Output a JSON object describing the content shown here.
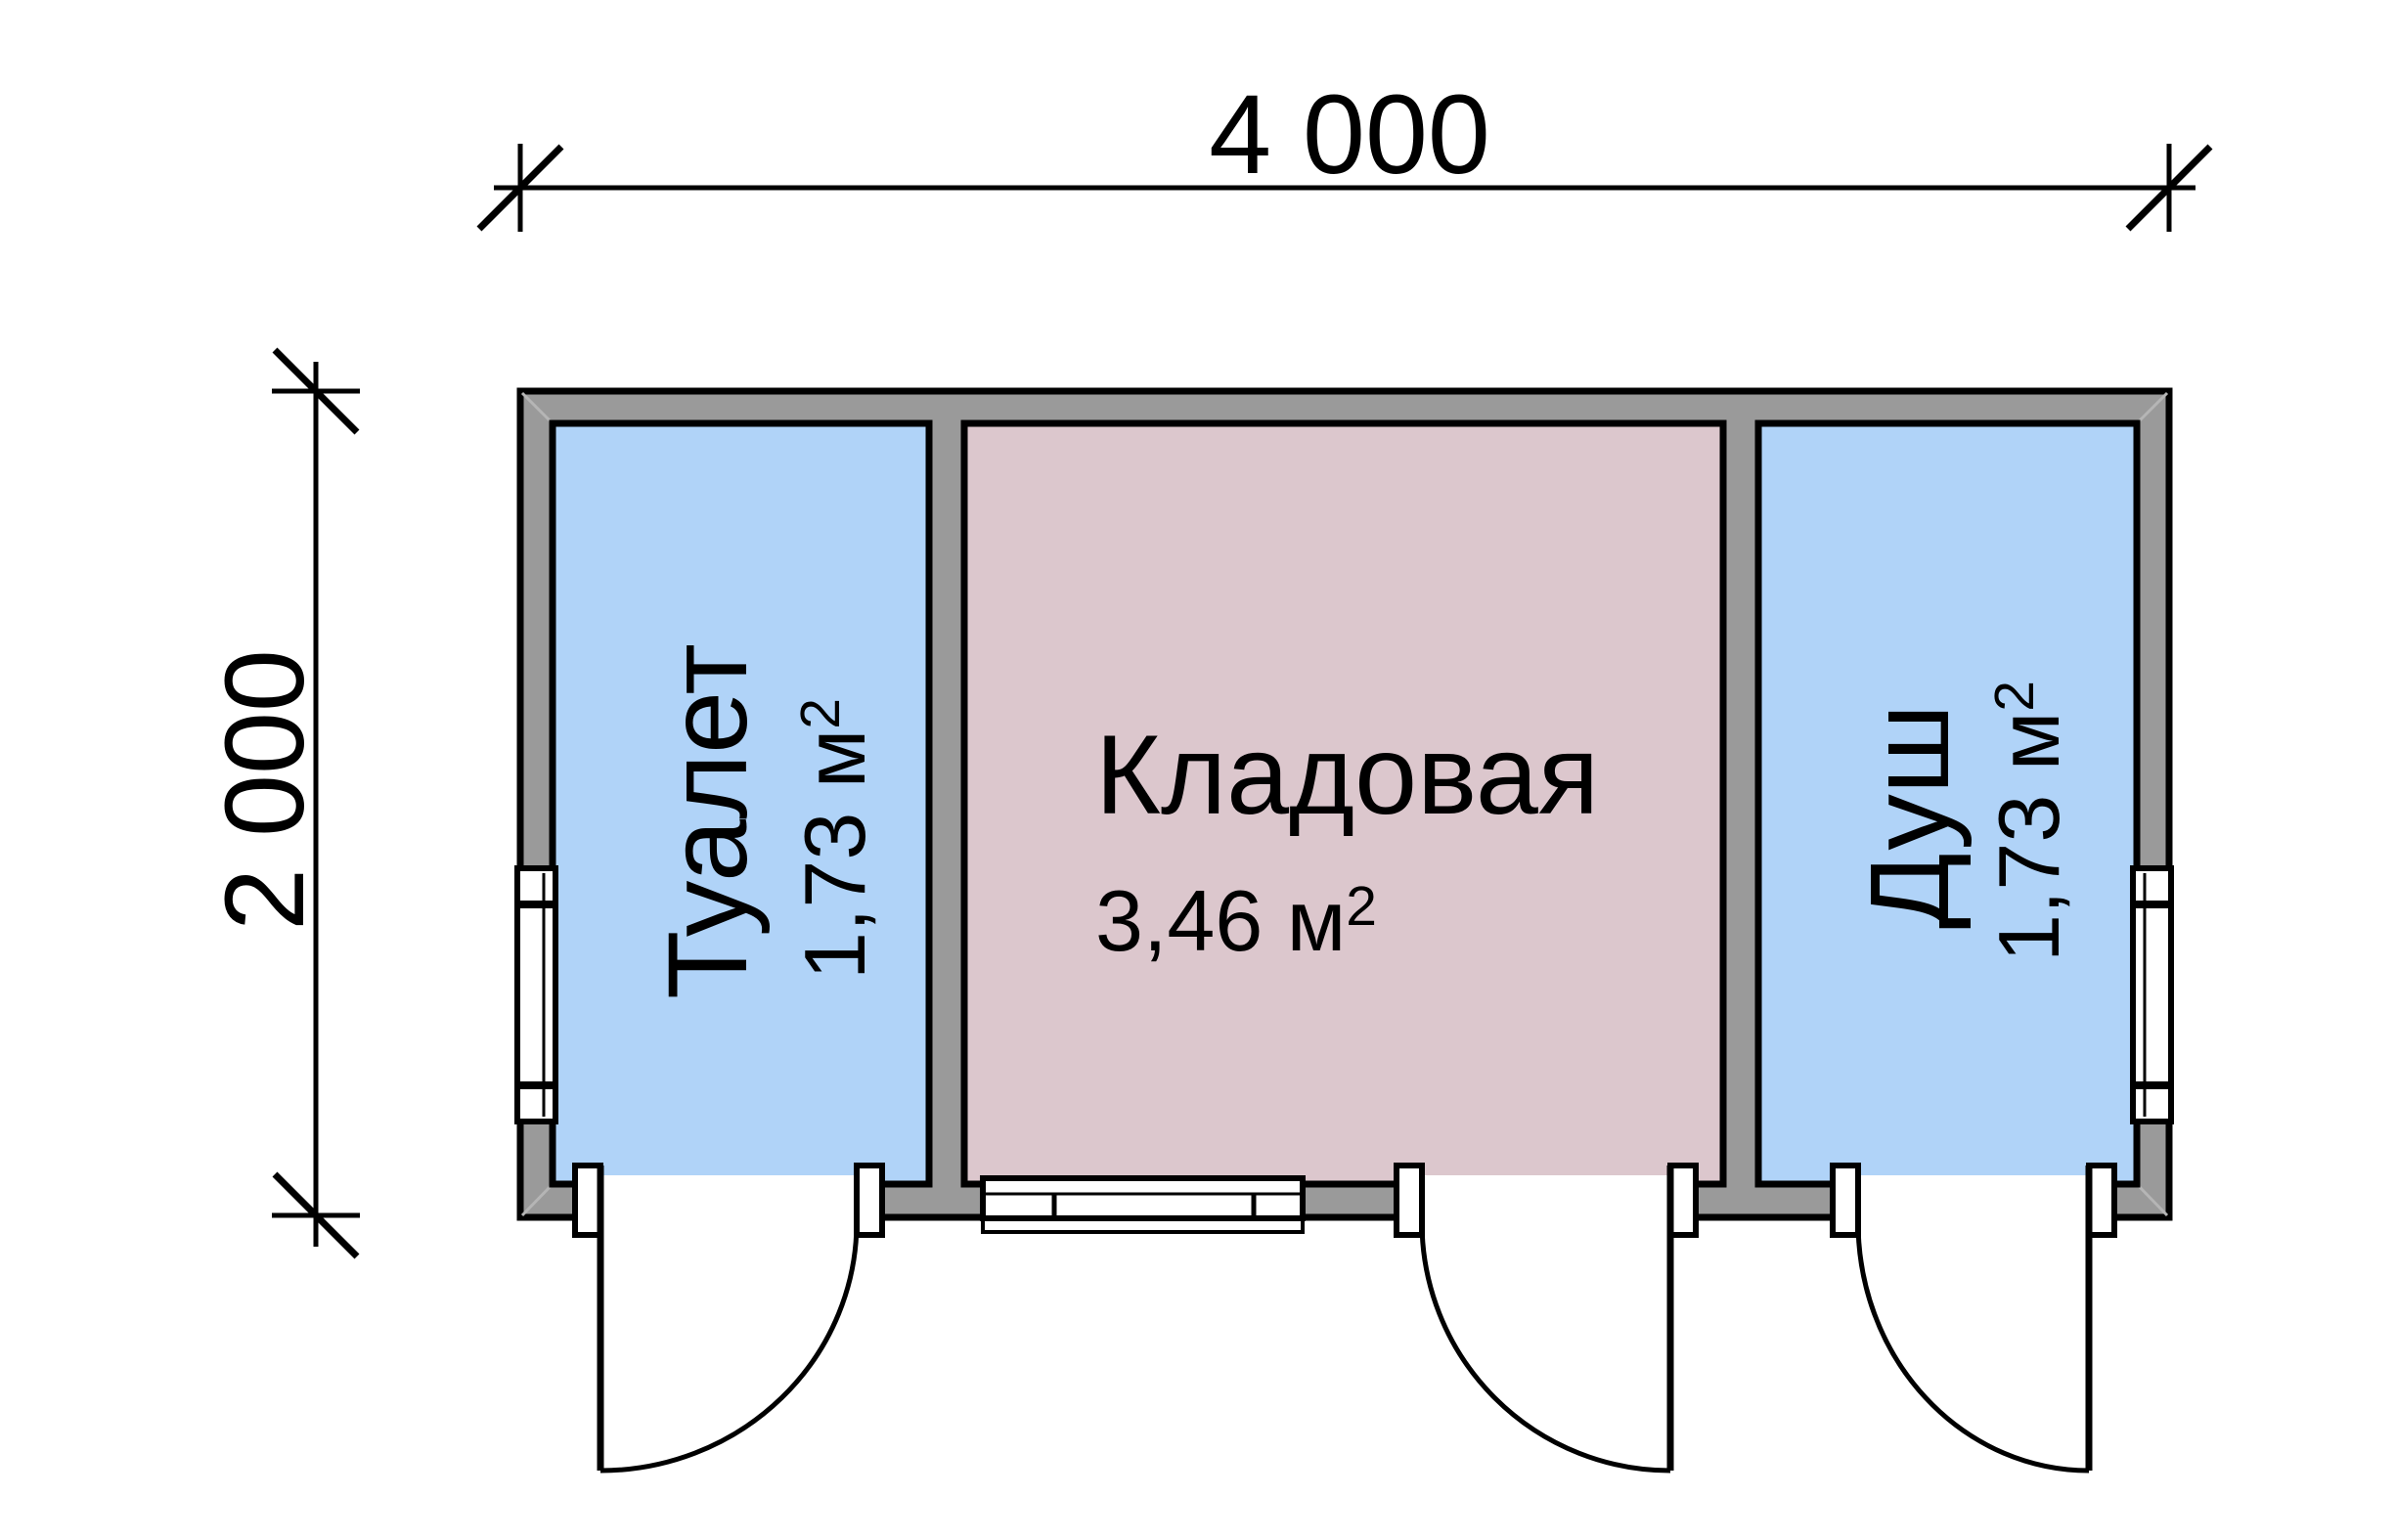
{
  "floor_plan": {
    "kind": "outbuilding-plan",
    "overall_width_label": "4 000",
    "overall_depth_label": "2 000",
    "rooms": [
      {
        "id": "toilet",
        "name": "Туалет",
        "area": "1,73 м²",
        "area_base": "1,73 м",
        "area_sup": "2",
        "fill": "#b0d3f8"
      },
      {
        "id": "storage",
        "name": "Кладовая",
        "area": "3,46 м²",
        "area_base": "3,46 м",
        "area_sup": "2",
        "fill": "#dcc7cd"
      },
      {
        "id": "shower",
        "name": "Душ",
        "area": "1,73 м²",
        "area_base": "1,73 м",
        "area_sup": "2",
        "fill": "#b0d3f8"
      }
    ],
    "colors": {
      "wall_fill": "#9a9a9a",
      "outline": "#000000",
      "room_blue": "#b0d3f8",
      "room_pink": "#dcc7cd",
      "background": "#ffffff",
      "miter": "#b5b5b5"
    },
    "features": {
      "doors": 3,
      "windows": 3
    }
  }
}
